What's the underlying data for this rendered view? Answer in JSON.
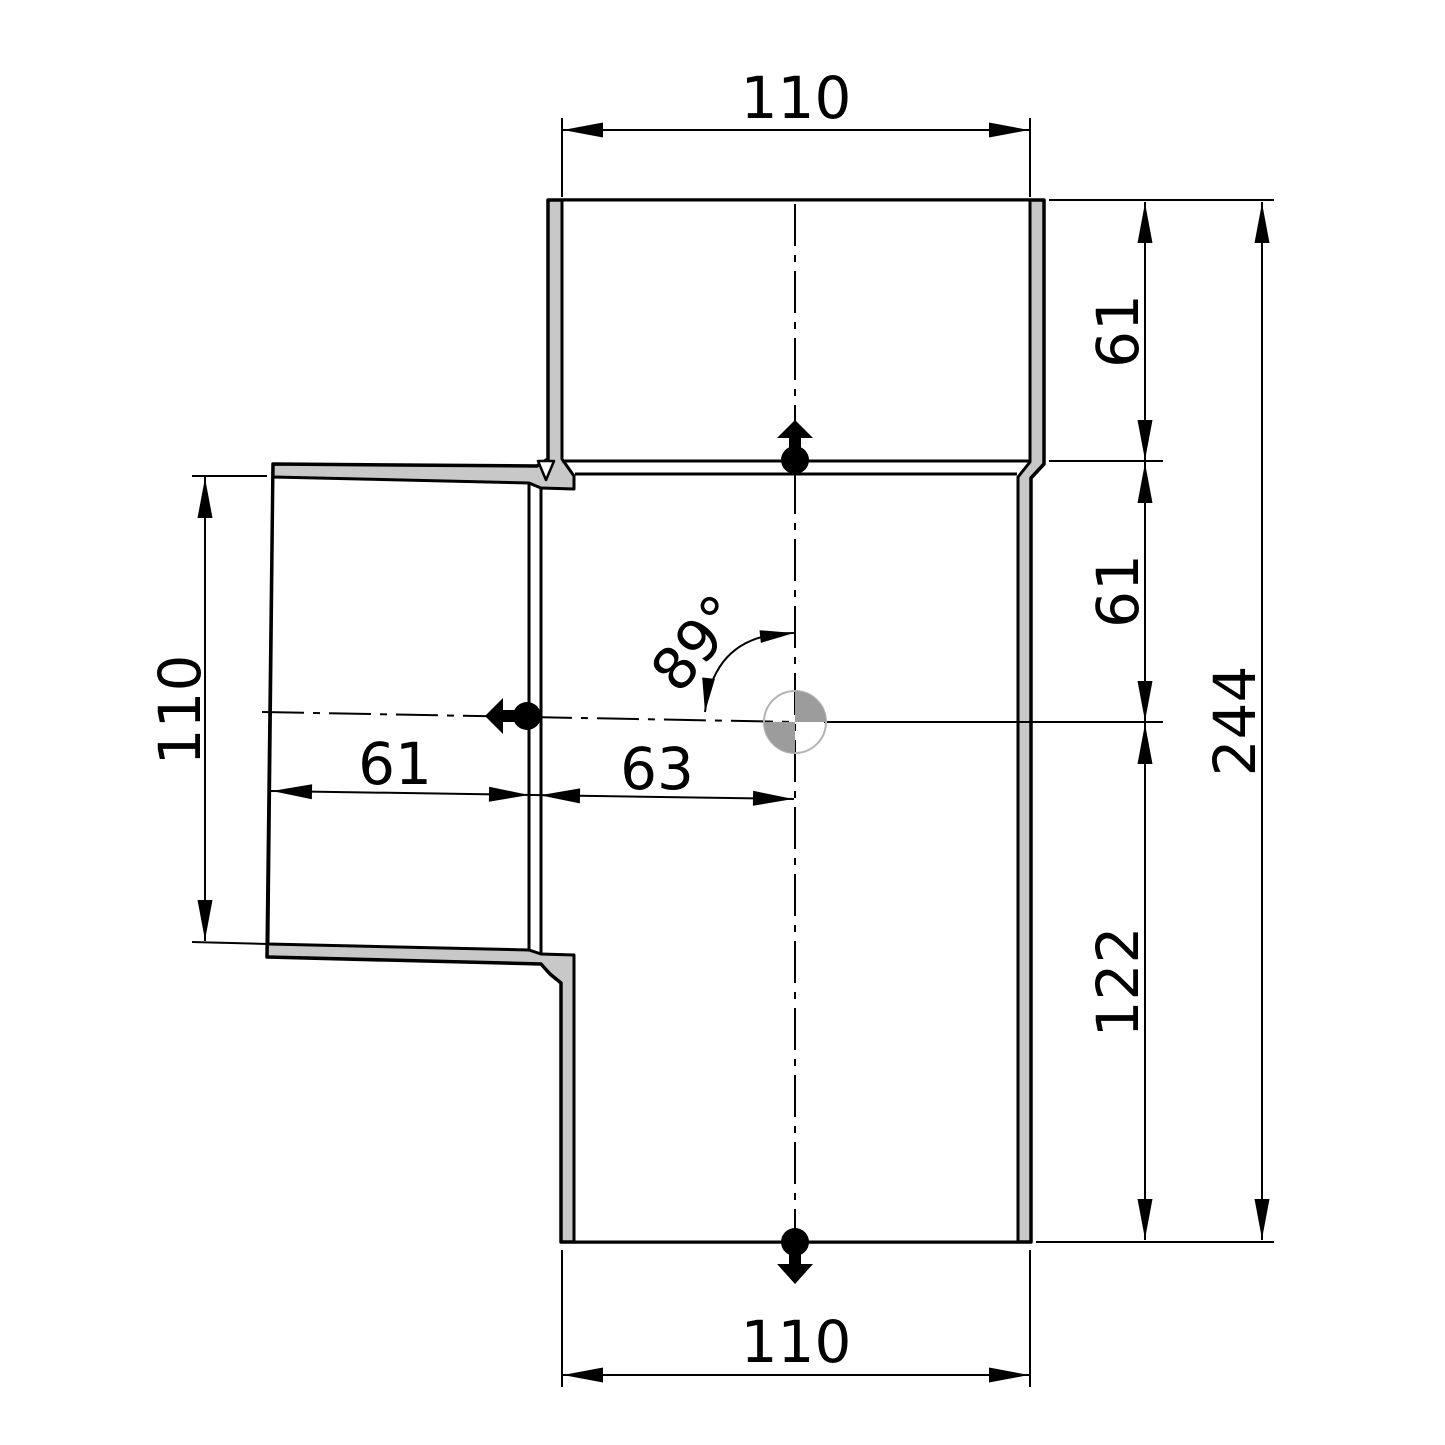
{
  "drawing_title": "89-degree tee fitting dimension drawing",
  "dimensions": {
    "top_width": "110",
    "right_socket_depth": "61",
    "right_branch_offset": "61",
    "overall_length": "244",
    "outlet_offset": "122",
    "branch_opening": "110",
    "branch_socket_depth": "61",
    "branch_center_offset": "63",
    "branch_angle": "89°",
    "bottom_width": "110"
  },
  "colors": {
    "background": "#ffffff",
    "line": "#000000",
    "wall_fill": "#c8c8c8",
    "cavity_fill": "#ffffff",
    "marker_fill": "#9c9c9c",
    "marker_ring": "#b4b4b4"
  }
}
